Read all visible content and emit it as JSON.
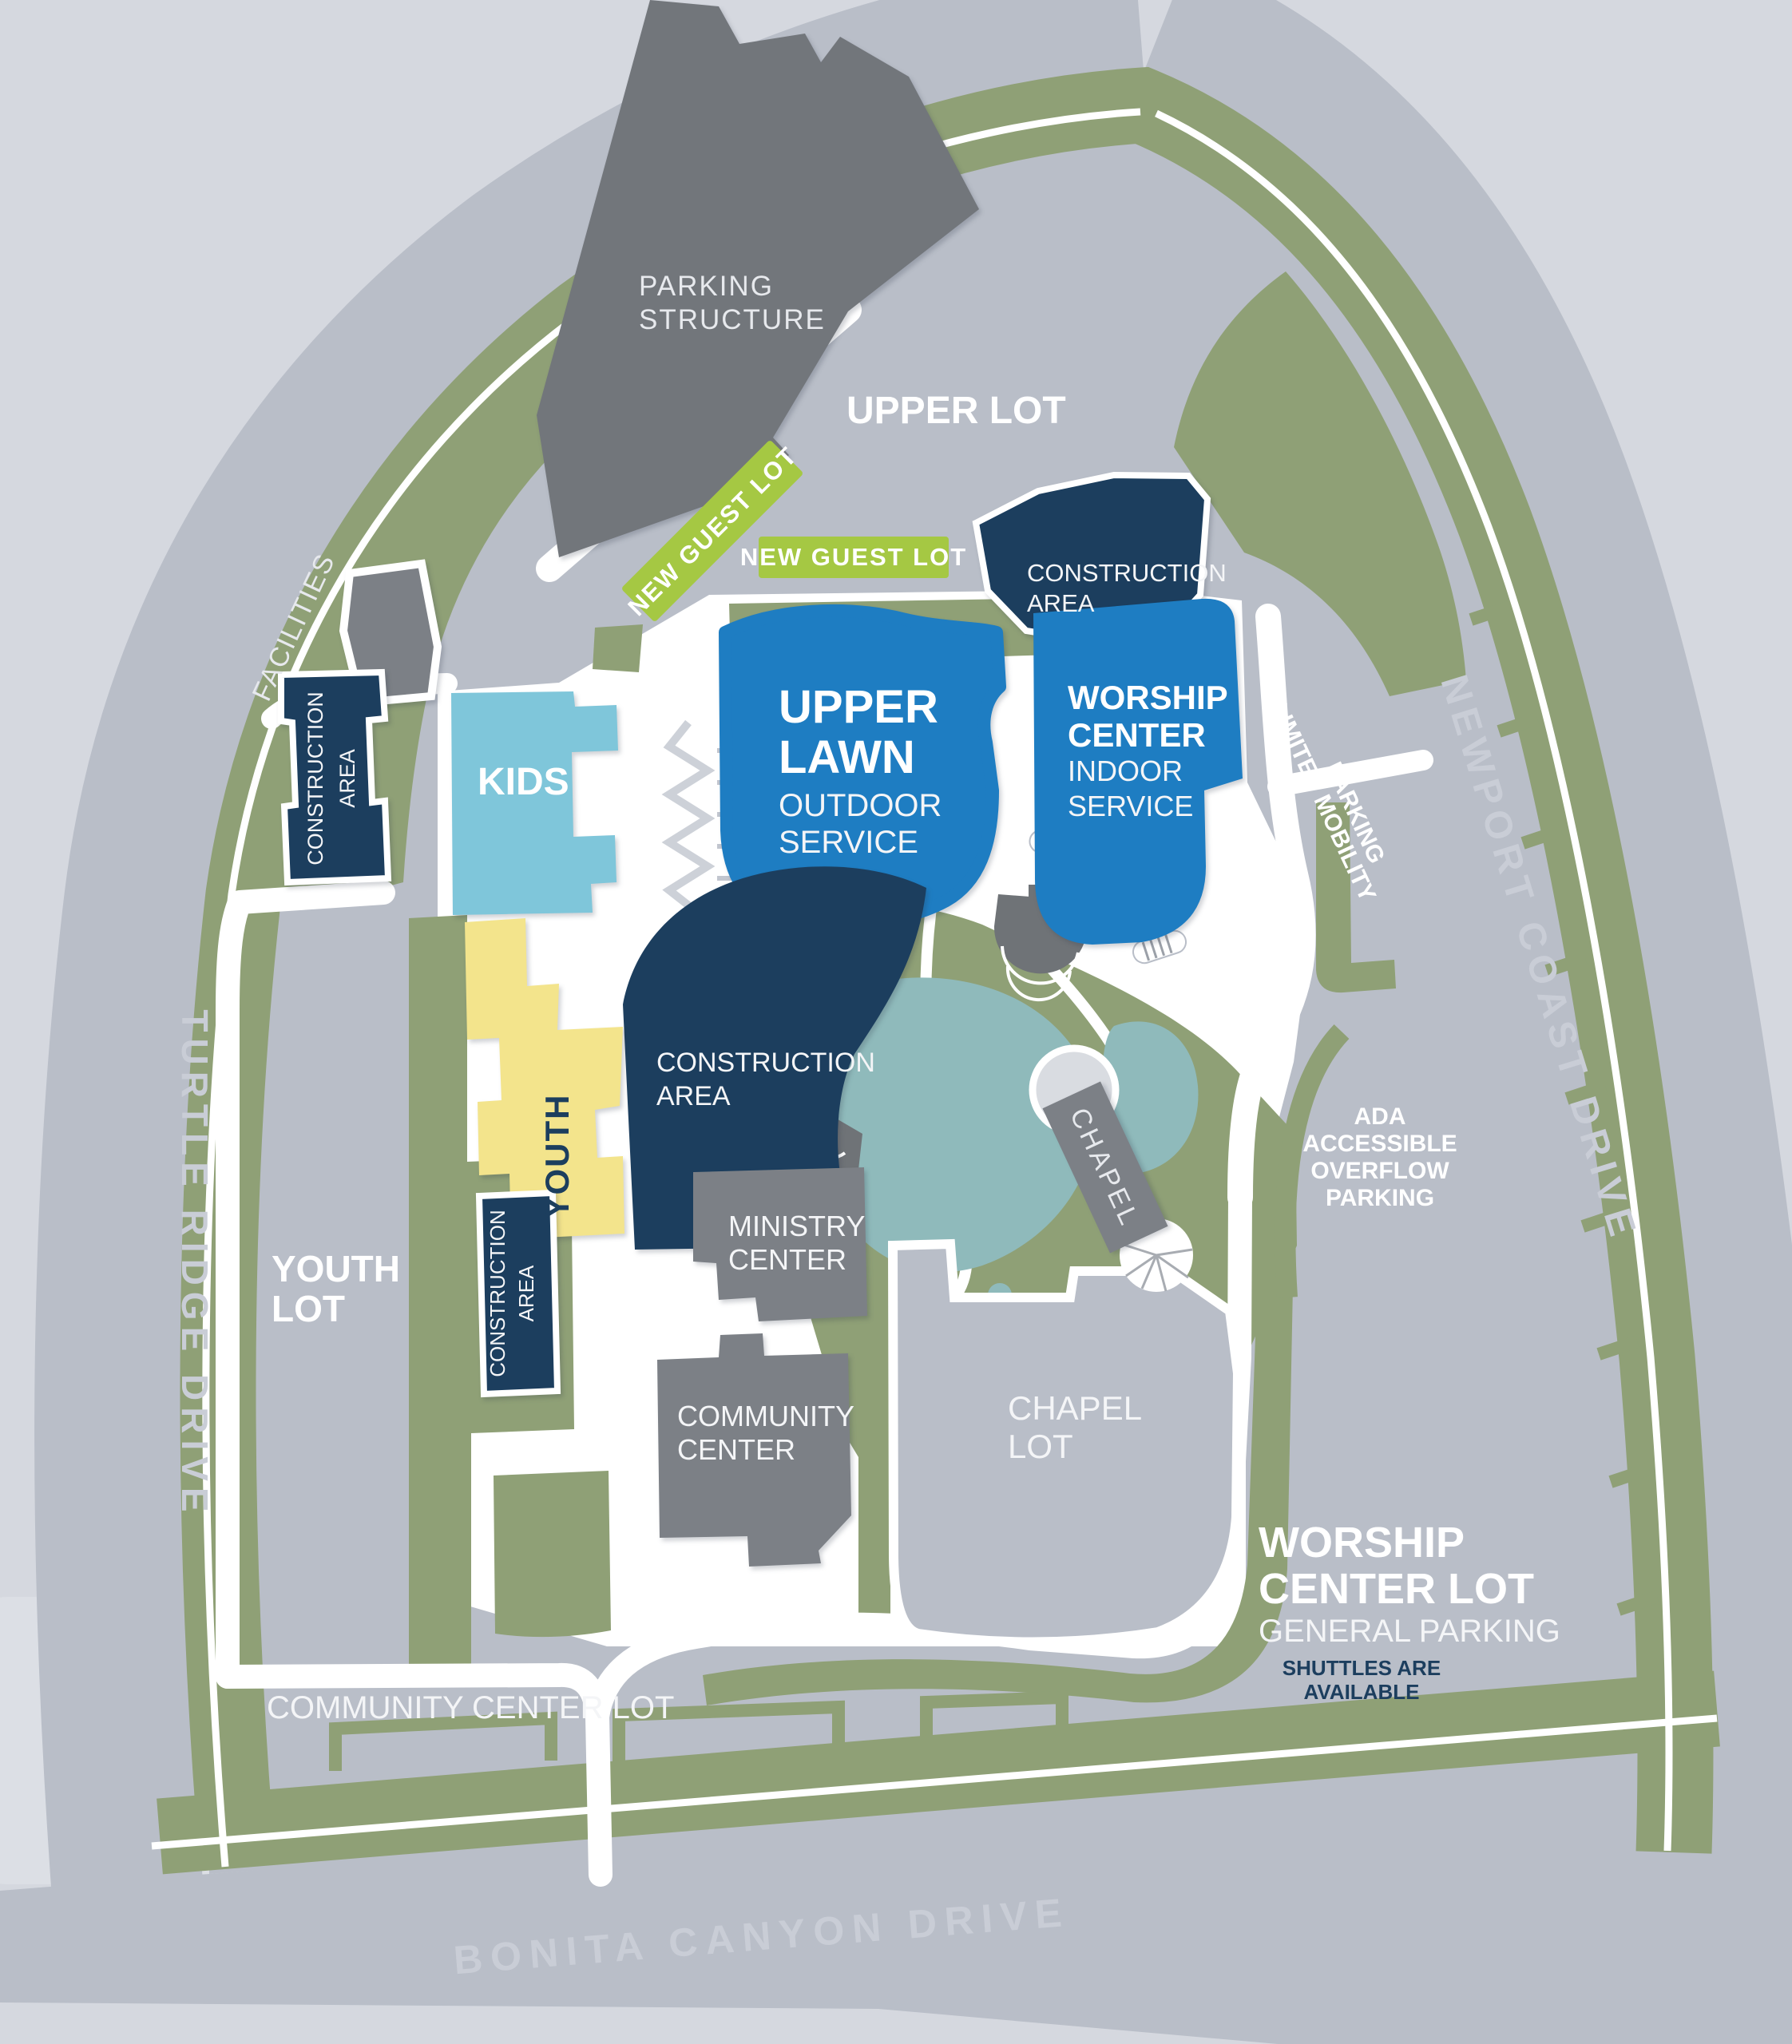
{
  "map": {
    "roads": {
      "turtle": "TURTLE RIDGE DRIVE",
      "newport": "NEWPORT COAST DRIVE",
      "bonita": "BONITA CANYON DRIVE"
    },
    "lots": {
      "upper": "UPPER LOT",
      "youth_l1": "YOUTH",
      "youth_l2": "LOT",
      "chapel_l1": "CHAPEL",
      "chapel_l2": "LOT",
      "community": "COMMUNITY CENTER LOT",
      "worship_l1": "WORSHIP",
      "worship_l2": "CENTER LOT",
      "worship_sub": "GENERAL PARKING",
      "worship_note_l1": "SHUTTLES ARE",
      "worship_note_l2": "AVAILABLE",
      "ada_l1": "ADA",
      "ada_l2": "ACCESSIBLE",
      "ada_l3": "OVERFLOW",
      "ada_l4": "PARKING",
      "limited_l1": "LIMITED MOBILITY",
      "limited_l2": "PARKING",
      "new_guest_a": "NEW GUEST LOT",
      "new_guest_b": "NEW GUEST LOT"
    },
    "buildings": {
      "parking_structure_l1": "PARKING",
      "parking_structure_l2": "STRUCTURE",
      "facilities": "FACILITIES",
      "kids": "KIDS",
      "upper_lawn_l1": "UPPER",
      "upper_lawn_l2": "LAWN",
      "upper_lawn_s1": "OUTDOOR",
      "upper_lawn_s2": "SERVICE",
      "worship_l1": "WORSHIP",
      "worship_l2": "CENTER",
      "worship_s1": "INDOOR",
      "worship_s2": "SERVICE",
      "youth": "YOUTH",
      "ministry_l1": "MINISTRY",
      "ministry_l2": "CENTER",
      "community_l1": "COMMUNITY",
      "community_l2": "CENTER",
      "chapel": "CHAPEL"
    },
    "construction": {
      "l1": "CONSTRUCTION",
      "l2": "AREA"
    },
    "colors": {
      "background": "#d5d8df",
      "road": "#b9bec8",
      "road_text": "#c9cdd6",
      "landscape_green": "#8fa076",
      "guest_lot_green": "#a5c843",
      "navy_construction": "#1c3e5e",
      "service_blue": "#1e7dc2",
      "kids_blue": "#7fc6da",
      "youth_yellow": "#f3e48c",
      "building_gray": "#7c8086",
      "structure_gray": "#72767b",
      "pond_teal": "#8fbabb",
      "white": "#ffffff",
      "light_block": "#dcdfe5"
    }
  }
}
